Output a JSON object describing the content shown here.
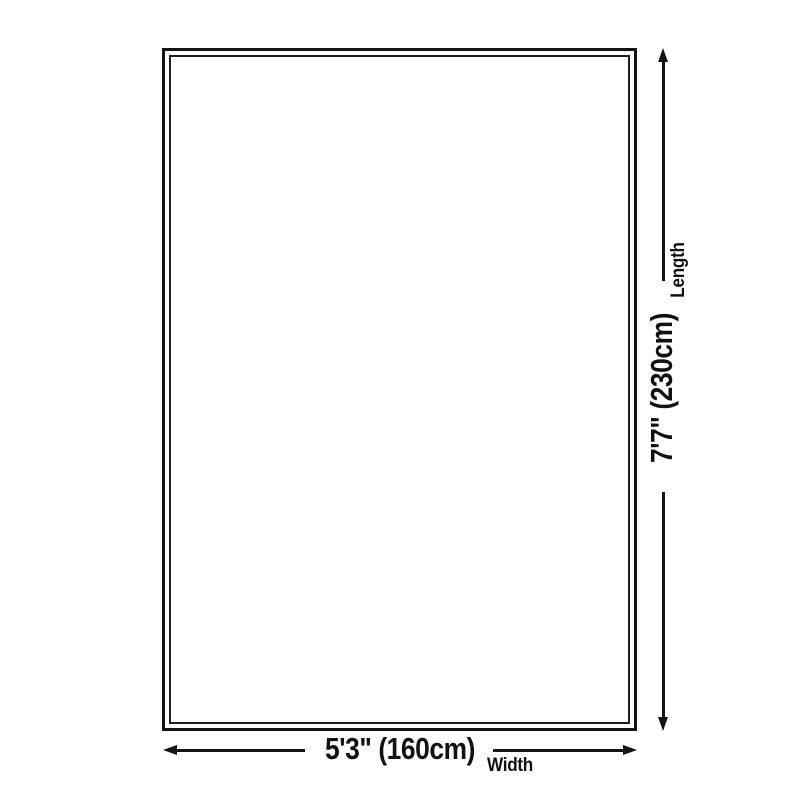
{
  "diagram": {
    "type": "product-size-diagram",
    "item": "rug-outline",
    "length": {
      "label": "Length",
      "value": "7'7\" (230cm)"
    },
    "width": {
      "label": "Width",
      "value": "5'3\" (160cm)"
    },
    "colors": {
      "line": "#141414",
      "text": "#111111",
      "background": "#ffffff"
    }
  }
}
